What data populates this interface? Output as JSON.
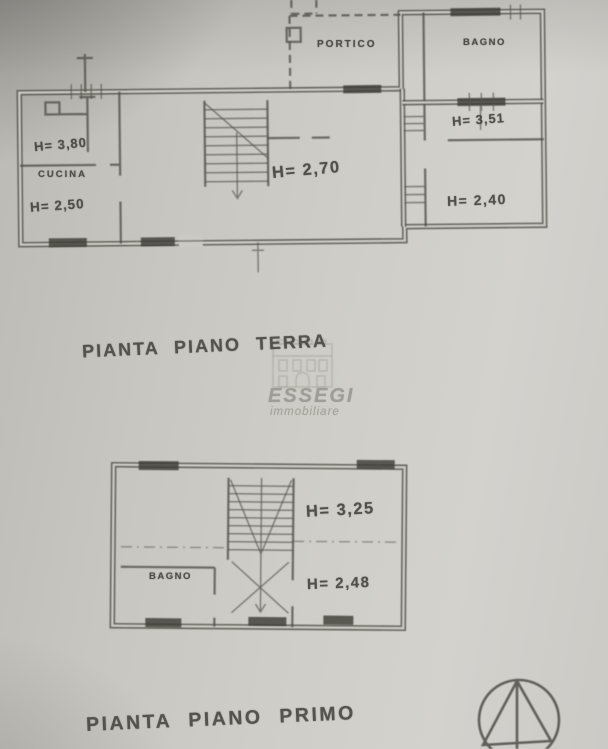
{
  "ground_floor": {
    "title": "PIANTA PIANO TERRA",
    "labels": {
      "storage_height": "H= 3,80",
      "kitchen": "CUCINA",
      "kitchen_height": "H= 2,50",
      "living_height": "H= 2,70",
      "portico": "PORTICO",
      "bathroom": "BAGNO",
      "hall_height": "H= 3,51",
      "bedroom_height": "H= 2,40"
    }
  },
  "first_floor": {
    "title": "PIANTA PIANO PRIMO",
    "labels": {
      "bathroom": "BAGNO",
      "stair_hall_height": "H= 3,25",
      "bedroom_height": "H= 2,48"
    }
  },
  "watermark": {
    "brand": "ESSEGI",
    "subtitle": "immobiliare",
    "icon": "building-facade-icon"
  },
  "compass_icon": "compass-north-arrow-icon",
  "colors": {
    "paper": "#cac9c3",
    "ink": "#4a4942",
    "watermark_gray": "#999891"
  }
}
